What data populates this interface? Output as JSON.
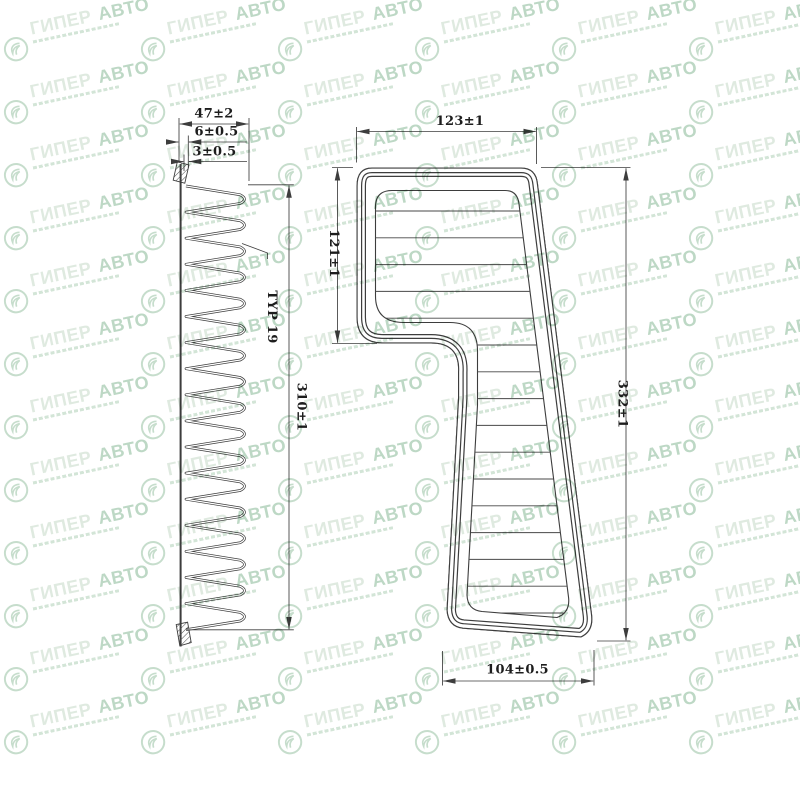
{
  "watermark": {
    "brand_primary": "ГИПЕР",
    "brand_secondary": "АВТО",
    "accent_color": "#bdd8c5"
  },
  "drawing": {
    "line_color": "#3d3d3d",
    "side_view": {
      "depth": "47±2",
      "seal_height": "6±0.5",
      "seal_lip": "3±0.5",
      "length": "310±1",
      "pleat_note": "TYP 19"
    },
    "front_view": {
      "top_width": "123±1",
      "upper_section_height": "121±1",
      "overall_length": "332±1",
      "bottom_width": "104±0.5"
    }
  }
}
